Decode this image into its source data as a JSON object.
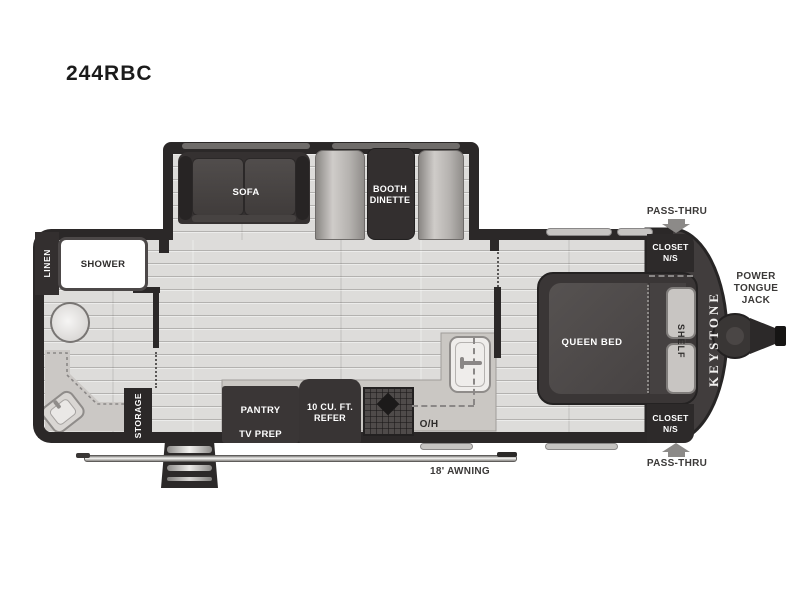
{
  "title": "244RBC",
  "labels": {
    "sofa": "SOFA",
    "dinette": "BOOTH DINETTE",
    "linen": "LINEN",
    "shower": "SHOWER",
    "storage": "STORAGE",
    "pantry": "PANTRY",
    "tv_prep": "TV PREP",
    "refer": "10 CU. FT. REFER",
    "overhead": "O/H",
    "queen_bed": "QUEEN BED",
    "shelf": "SHELF",
    "closet_top": "CLOSET N/S",
    "closet_bottom": "CLOSET N/S",
    "brand": "KEYSTONE",
    "pass_thru_top": "PASS-THRU",
    "pass_thru_bottom": "PASS-THRU",
    "power_tongue_jack": "POWER TONGUE JACK",
    "awning": "18' AWNING"
  },
  "colors": {
    "wall": "#2b2828",
    "furniture_dark": "#3a3636",
    "bench_light": "#bdbab7",
    "floor": "#dddcda",
    "counter": "#cbc8c5",
    "label_dark": "#2e2c2b",
    "label_outside": "#3b3938",
    "arrow_gray": "#8c8a88",
    "cap_dark": "#413d3d"
  }
}
